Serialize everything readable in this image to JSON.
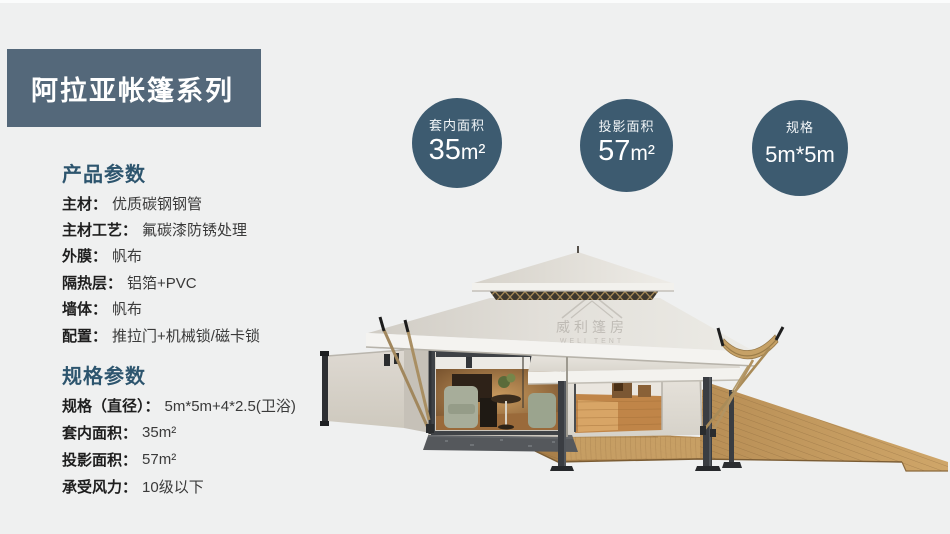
{
  "banner": {
    "title": "阿拉亚帐篷系列"
  },
  "product_params": {
    "heading": "产品参数",
    "items": [
      {
        "label": "主材：",
        "value": "优质碳钢钢管"
      },
      {
        "label": "主材工艺：",
        "value": "氟碳漆防锈处理"
      },
      {
        "label": "外膜：",
        "value": "帆布"
      },
      {
        "label": "隔热层：",
        "value": "铝箔+PVC"
      },
      {
        "label": "墙体：",
        "value": "帆布"
      },
      {
        "label": "配置：",
        "value": "推拉门+机械锁/磁卡锁"
      }
    ]
  },
  "spec_params": {
    "heading": "规格参数",
    "items": [
      {
        "label": "规格（直径）：",
        "value": "5m*5m+4*2.5(卫浴)"
      },
      {
        "label": "套内面积：",
        "value": "35m²"
      },
      {
        "label": "投影面积：",
        "value": "57m²"
      },
      {
        "label": "承受风力：",
        "value": "10级以下"
      }
    ]
  },
  "badges": [
    {
      "label": "套内面积",
      "value": "35",
      "unit": "m²"
    },
    {
      "label": "投影面积",
      "value": "57",
      "unit": "m²"
    },
    {
      "label": "规格",
      "value": "5m*5m",
      "unit": ""
    }
  ],
  "watermark": {
    "cn": "威利篷房",
    "en": "WELI TENT"
  },
  "colors": {
    "banner": "#54687a",
    "badge": "#3d5b70",
    "heading": "#2d556e"
  }
}
